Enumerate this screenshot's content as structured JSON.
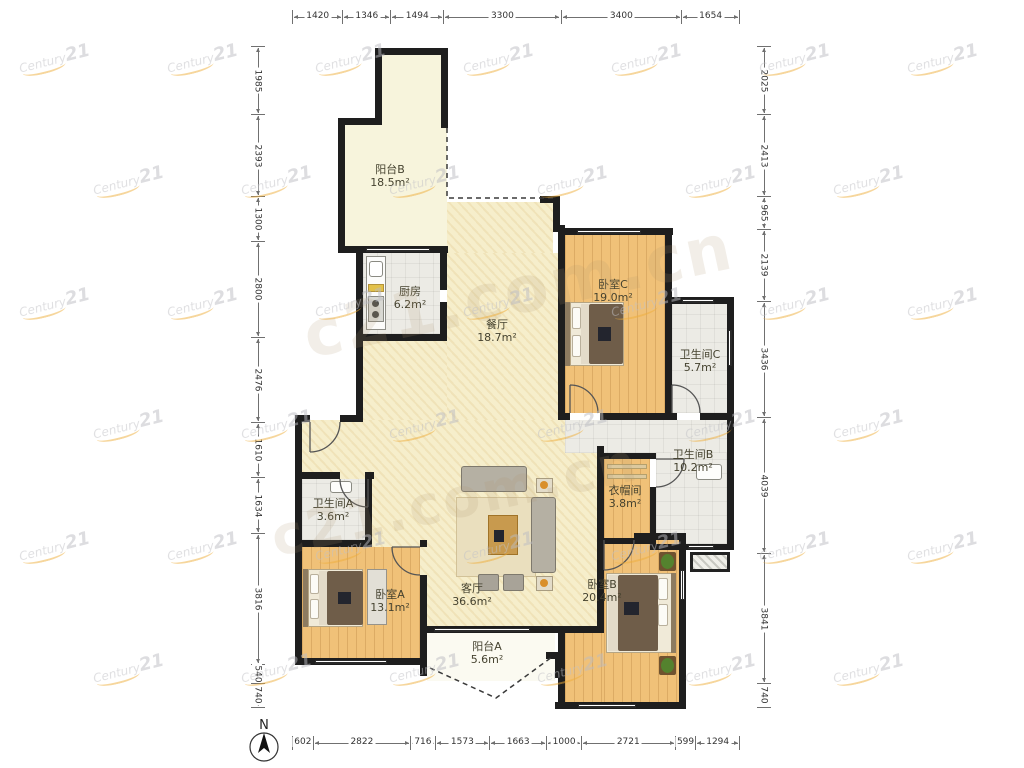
{
  "watermark": {
    "small_prefix": "Century",
    "small_suffix": "21",
    "big_text": "c21.com.cn"
  },
  "compass": {
    "label": "N"
  },
  "colors": {
    "wall": "#1e1e1e",
    "wood_floor": "#f0c178",
    "main_floor": "#f6eecb",
    "tile_floor": "#ecebe5",
    "watermark_orange": "#efae3b"
  },
  "rulers": {
    "top": [
      1420,
      1346,
      1494,
      3300,
      3400,
      1654
    ],
    "bottom": [
      602,
      2822,
      716,
      1573,
      1663,
      1000,
      2721,
      599,
      1294
    ],
    "left": [
      1985,
      2393,
      1300,
      2800,
      2476,
      1610,
      1634,
      3816,
      540,
      740
    ],
    "right": [
      2025,
      2413,
      965,
      2139,
      3436,
      4039,
      3841,
      740
    ]
  },
  "rooms": [
    {
      "id": "balcony-b",
      "name": "阳台B",
      "area": "18.5m²"
    },
    {
      "id": "kitchen",
      "name": "厨房",
      "area": "6.2m²"
    },
    {
      "id": "dining",
      "name": "餐厅",
      "area": "18.7m²"
    },
    {
      "id": "bedroom-c",
      "name": "卧室C",
      "area": "19.0m²"
    },
    {
      "id": "bath-c",
      "name": "卫生间C",
      "area": "5.7m²"
    },
    {
      "id": "bath-b",
      "name": "卫生间B",
      "area": "10.2m²"
    },
    {
      "id": "cloakroom",
      "name": "衣帽间",
      "area": "3.8m²"
    },
    {
      "id": "bath-a",
      "name": "卫生间A",
      "area": "3.6m²"
    },
    {
      "id": "bedroom-a",
      "name": "卧室A",
      "area": "13.1m²"
    },
    {
      "id": "living",
      "name": "客厅",
      "area": "36.6m²"
    },
    {
      "id": "balcony-a",
      "name": "阳台A",
      "area": "5.6m²"
    },
    {
      "id": "bedroom-b",
      "name": "卧室B",
      "area": "20.4m²"
    }
  ]
}
